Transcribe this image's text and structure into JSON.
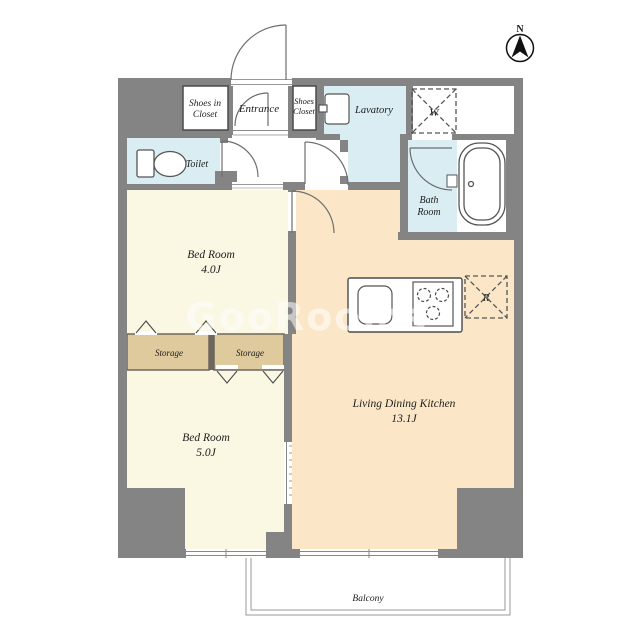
{
  "plan": {
    "compass": "N",
    "watermark": "GooRooms",
    "rooms": {
      "shoes_in_closet": {
        "l1": "Shoes in",
        "l2": "Closet"
      },
      "entrance": {
        "l1": "Entrance"
      },
      "shoes_closet": {
        "l1": "Shoes",
        "l2": "Closet"
      },
      "lavatory": {
        "l1": "Lavatory"
      },
      "toilet": {
        "l1": "Toilet"
      },
      "bath": {
        "l1": "Bath",
        "l2": "Room"
      },
      "bedroom4": {
        "l1": "Bed Room",
        "l2": "4.0J"
      },
      "storage_left": {
        "l1": "Storage"
      },
      "storage_right": {
        "l1": "Storage"
      },
      "bedroom5": {
        "l1": "Bed Room",
        "l2": "5.0J"
      },
      "ldk": {
        "l1": "Living Dining Kitchen",
        "l2": "13.1J"
      },
      "balcony": {
        "l1": "Balcony"
      }
    },
    "appliances": {
      "washer": "W",
      "fridge": "R"
    },
    "colors": {
      "wall": "#848484",
      "bedroom_floor": "#faf7e2",
      "ldk_floor": "#fbe7c7",
      "wet_area_floor": "#d9edf3",
      "storage_floor": "#dfca9d",
      "outline": "#4a4a4a"
    }
  }
}
